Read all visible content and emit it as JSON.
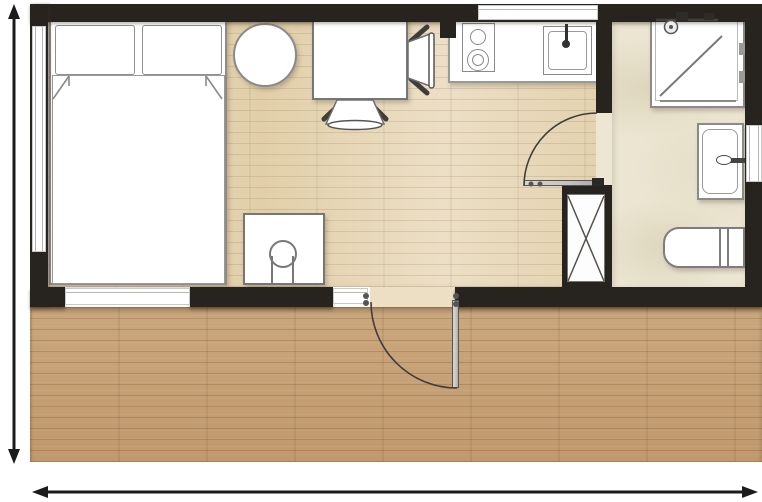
{
  "page": {
    "type": "architectural floor plan",
    "description": "Top-down floor plan of a studio cabin with one main room, a bathroom on the right, and a wooden deck along the front; dimension arrows on the left and bottom edges; no text labels visible"
  },
  "floorplan": {
    "rooms": [
      {
        "id": "main-room",
        "floor_material": "light wood plank",
        "contents": [
          "double-bed",
          "pillow-left",
          "pillow-right",
          "duvet",
          "round-table",
          "dining-table",
          "dining-chair-right",
          "dining-chair-bottom",
          "desk",
          "round-stool",
          "kitchen-counter",
          "two-burner-cooktop",
          "kitchen-sink"
        ]
      },
      {
        "id": "bathroom",
        "floor_material": "beige stone tile",
        "contents": [
          "shower",
          "shower-head",
          "washbasin",
          "toilet",
          "service-shaft"
        ]
      },
      {
        "id": "deck",
        "floor_material": "wood decking",
        "contents": []
      }
    ],
    "openings": {
      "doors": [
        {
          "id": "entrance-door",
          "wall": "south",
          "swing": "outward-onto-deck",
          "state": "shown-open-with-arc"
        },
        {
          "id": "bathroom-door",
          "wall": "interior-partition",
          "swing": "into-main-room",
          "state": "shown-open-with-arc"
        }
      ],
      "windows": [
        "window-west",
        "window-south",
        "entrance-sidelight-window",
        "kitchen-window",
        "bathroom-window"
      ]
    },
    "dimension_markers": [
      "vertical-extent-arrow-left",
      "horizontal-extent-arrow-bottom"
    ],
    "colors": {
      "wall": "#272420",
      "wood_floor": "#e7d5b4",
      "tile_floor": "#ebe5d1",
      "deck": "#c7a278",
      "furniture_fill": "#ffffff",
      "outline": "#8a8a8a",
      "door_leaf": "#c6c5c3",
      "dimension": "#1b1b1b",
      "background": "#ffffff"
    }
  }
}
